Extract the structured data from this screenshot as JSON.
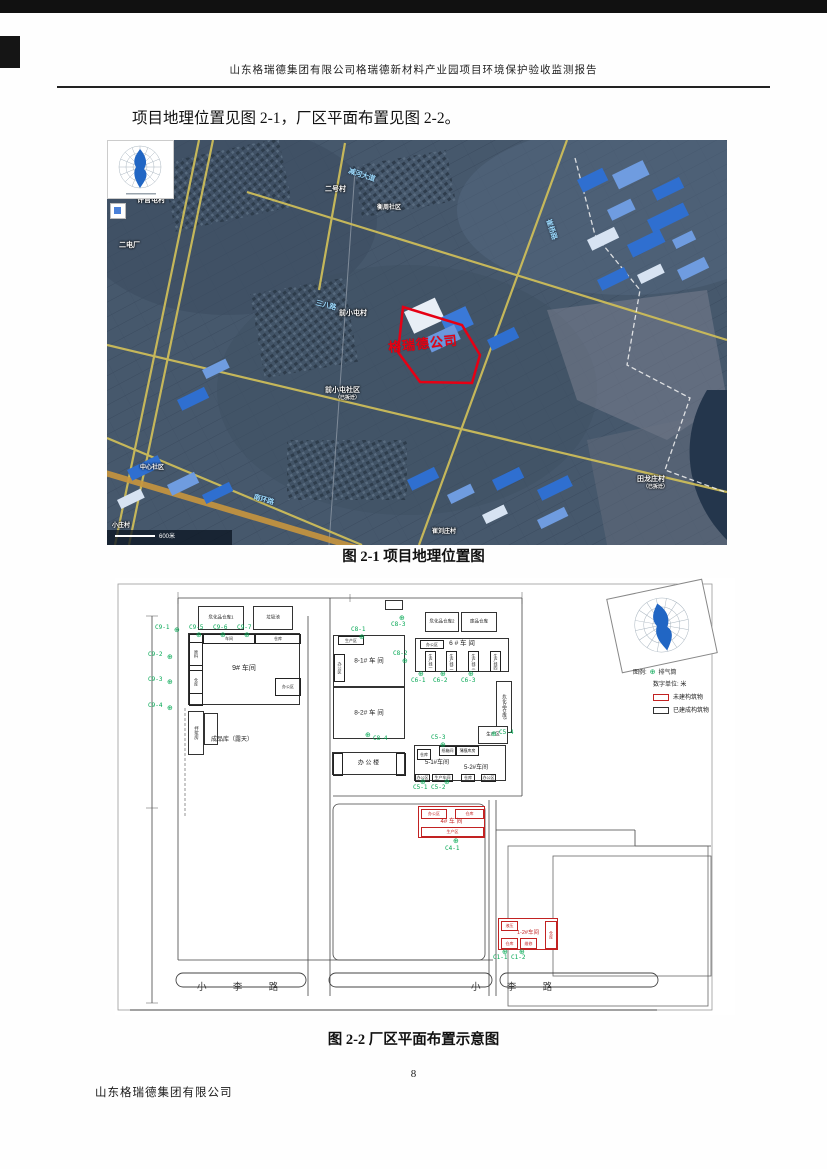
{
  "page": {
    "header": "山东格瑞德集团有限公司格瑞德新材料产业园项目环境保护验收监测报告",
    "intro": "项目地理位置见图 2-1，厂区平面布置见图 2-2。",
    "fig1_caption": "图 2-1 项目地理位置图",
    "fig2_caption": "图 2-2 厂区平面布置示意图",
    "page_number": "8",
    "footer": "山东格瑞德集团有限公司"
  },
  "map": {
    "scale_text": "600米",
    "labels": [
      {
        "t": "许官屯村",
        "x": 30,
        "y": 55
      },
      {
        "t": "二电厂",
        "x": 12,
        "y": 100
      },
      {
        "t": "二号村",
        "x": 218,
        "y": 44
      },
      {
        "t": "衡周社区",
        "x": 270,
        "y": 62,
        "fs": 6
      },
      {
        "t": "前小屯村",
        "x": 232,
        "y": 168
      },
      {
        "t": "前小屯社区",
        "x": 218,
        "y": 245
      },
      {
        "t": "（已拆迁）",
        "x": 228,
        "y": 254,
        "fs": 5
      },
      {
        "t": "中心社区",
        "x": 33,
        "y": 322,
        "fs": 6
      },
      {
        "t": "田龙庄村",
        "x": 530,
        "y": 334
      },
      {
        "t": "（已拆迁）",
        "x": 536,
        "y": 343,
        "fs": 5
      },
      {
        "t": "崔刘庄村",
        "x": 325,
        "y": 386,
        "fs": 6
      },
      {
        "t": "小庄村",
        "x": 5,
        "y": 380,
        "fs": 6
      },
      {
        "t": "格瑞德公司",
        "x": 280,
        "y": 197,
        "cls": "red",
        "fs": 13,
        "rot": -6
      }
    ],
    "road_labels": [
      {
        "t": "减河大道",
        "x": 243,
        "y": 26,
        "rot": 18
      },
      {
        "t": "崔杨路",
        "x": 446,
        "y": 78,
        "rot": 72
      },
      {
        "t": "三八路",
        "x": 210,
        "y": 158,
        "rot": 14
      },
      {
        "t": "南环路",
        "x": 148,
        "y": 352,
        "rot": 16
      }
    ]
  },
  "plan": {
    "legend": {
      "title": "图例:",
      "stack": "排气筒",
      "unit": "数字单位: 米",
      "red": "未建构筑物",
      "black": "已建成构筑物"
    },
    "roads": {
      "left": "小 李 路",
      "right": "小 李 路"
    },
    "free_labels": [
      {
        "t": "成品库（露天）",
        "x": 96,
        "y": 156,
        "fs": 6
      },
      {
        "t": "5-1#车间",
        "x": 310,
        "y": 179,
        "fs": 6
      },
      {
        "t": "5-2#车间",
        "x": 349,
        "y": 184,
        "fs": 6
      }
    ],
    "buildings": [
      {
        "label": "危化品仓库1",
        "x": 83,
        "y": 28,
        "w": 46,
        "h": 24,
        "c": "k",
        "fs": 4.5
      },
      {
        "label": "垃圾池",
        "x": 138,
        "y": 28,
        "w": 40,
        "h": 24,
        "c": "k",
        "fs": 4.5
      },
      {
        "label": "9# 车间",
        "x": 73,
        "y": 55,
        "w": 112,
        "h": 72,
        "c": "k",
        "fs": 7,
        "rooms": [
          {
            "x": 0,
            "y": 0,
            "w": 14,
            "h": 72
          },
          {
            "x": 0,
            "y": 8,
            "w": 14,
            "h": 24,
            "t": "原料",
            "v": 1
          },
          {
            "x": 0,
            "y": 36,
            "w": 14,
            "h": 24,
            "t": "仓库",
            "v": 1
          },
          {
            "x": 14,
            "y": 0,
            "w": 52,
            "h": 10,
            "t": "车间"
          },
          {
            "x": 66,
            "y": 0,
            "w": 46,
            "h": 10,
            "t": "仓库"
          },
          {
            "x": 86,
            "y": 44,
            "w": 26,
            "h": 18,
            "t": "办公区"
          }
        ]
      },
      {
        "label": "拌浆房",
        "x": 73,
        "y": 133,
        "w": 16,
        "h": 44,
        "c": "k",
        "v": 1,
        "fs": 4.5
      },
      {
        "label": "",
        "x": 89,
        "y": 135,
        "w": 14,
        "h": 32,
        "c": "k"
      },
      {
        "label": "8-1# 车 间",
        "x": 218,
        "y": 57,
        "w": 72,
        "h": 52,
        "c": "k",
        "fs": 6.5,
        "rooms": [
          {
            "x": 4,
            "y": 0,
            "w": 26,
            "h": 9,
            "t": "生产区"
          },
          {
            "x": 0,
            "y": 18,
            "w": 11,
            "h": 28,
            "t": "办公区",
            "v": 1
          }
        ]
      },
      {
        "label": "8-2# 车 间",
        "x": 218,
        "y": 109,
        "w": 72,
        "h": 52,
        "c": "k",
        "fs": 6.5
      },
      {
        "label": "办 公 楼",
        "x": 217,
        "y": 174,
        "w": 73,
        "h": 23,
        "c": "k",
        "fs": 6,
        "rooms": [
          {
            "x": 0,
            "y": 0,
            "w": 10,
            "h": 23
          },
          {
            "x": 63,
            "y": 0,
            "w": 10,
            "h": 23
          }
        ]
      },
      {
        "label": "危化品仓库2",
        "x": 310,
        "y": 34,
        "w": 34,
        "h": 20,
        "c": "k",
        "fs": 4.5
      },
      {
        "label": "废品仓库",
        "x": 346,
        "y": 34,
        "w": 36,
        "h": 20,
        "c": "k",
        "fs": 4.5
      },
      {
        "label": "6 # 车 间",
        "x": 300,
        "y": 60,
        "w": 94,
        "h": 34,
        "c": "k",
        "fs": 6.5,
        "ly": 1,
        "rooms": [
          {
            "x": 4,
            "y": 1,
            "w": 24,
            "h": 9,
            "t": "办公区"
          },
          {
            "x": 9,
            "y": 12,
            "w": 11,
            "h": 21,
            "t": "生产线一",
            "v": 1
          },
          {
            "x": 30,
            "y": 12,
            "w": 11,
            "h": 21,
            "t": "生产线二",
            "v": 1
          },
          {
            "x": 52,
            "y": 12,
            "w": 11,
            "h": 21,
            "t": "生产线三",
            "v": 1
          },
          {
            "x": 74,
            "y": 12,
            "w": 11,
            "h": 21,
            "t": "生产线四",
            "v": 1
          }
        ]
      },
      {
        "label": "危化品仓库3",
        "x": 381,
        "y": 103,
        "w": 16,
        "h": 52,
        "c": "k",
        "v": 1,
        "fs": 4.5
      },
      {
        "label": "生产区",
        "x": 363,
        "y": 148,
        "w": 30,
        "h": 18,
        "c": "k",
        "fs": 4.5
      },
      {
        "label": "",
        "x": 299,
        "y": 167,
        "w": 92,
        "h": 36,
        "c": "k",
        "rooms": [
          {
            "x": 2,
            "y": 3,
            "w": 14,
            "h": 11,
            "t": "仓库"
          },
          {
            "x": 24,
            "y": 0,
            "w": 17,
            "h": 10,
            "t": "纸箱间"
          },
          {
            "x": 41,
            "y": 0,
            "w": 23,
            "h": 10,
            "t": "薄膜库房"
          },
          {
            "x": 0,
            "y": 28,
            "w": 15,
            "h": 8,
            "t": "办公区"
          },
          {
            "x": 17,
            "y": 28,
            "w": 21,
            "h": 8,
            "t": "生产车间"
          },
          {
            "x": 46,
            "y": 28,
            "w": 14,
            "h": 8,
            "t": "仓库"
          },
          {
            "x": 66,
            "y": 28,
            "w": 15,
            "h": 8,
            "t": "办公区"
          }
        ]
      },
      {
        "label": "4# 车 间",
        "x": 303,
        "y": 228,
        "w": 67,
        "h": 32,
        "c": "r",
        "ly": 12,
        "fs": 6,
        "rooms": [
          {
            "x": 2,
            "y": 2,
            "w": 26,
            "h": 10,
            "t": "办公区"
          },
          {
            "x": 36,
            "y": 2,
            "w": 29,
            "h": 10,
            "t": "仓库"
          },
          {
            "x": 2,
            "y": 20,
            "w": 63,
            "h": 10,
            "t": "生产区"
          }
        ]
      },
      {
        "label": "1-2#车间",
        "x": 383,
        "y": 340,
        "w": 60,
        "h": 32,
        "c": "r",
        "ly": 11,
        "fs": 5.5,
        "rooms": [
          {
            "x": 2,
            "y": 2,
            "w": 17,
            "h": 10,
            "t": "液压"
          },
          {
            "x": 2,
            "y": 19,
            "w": 17,
            "h": 11,
            "t": "仓库"
          },
          {
            "x": 21,
            "y": 19,
            "w": 17,
            "h": 11,
            "t": "维修"
          },
          {
            "x": 46,
            "y": 2,
            "w": 12,
            "h": 28,
            "t": "仓库",
            "v": 1
          }
        ]
      },
      {
        "label": "",
        "x": 270,
        "y": 22,
        "w": 18,
        "h": 10,
        "c": "k"
      }
    ],
    "monitor_points": [
      {
        "id": "C9-1",
        "t": [
          40,
          46
        ],
        "d": [
          59,
          49
        ]
      },
      {
        "id": "C9-5",
        "t": [
          74,
          46
        ],
        "d": [
          81,
          54
        ]
      },
      {
        "id": "C9-6",
        "t": [
          98,
          46
        ],
        "d": [
          105,
          54
        ]
      },
      {
        "id": "C9-7",
        "t": [
          122,
          46
        ],
        "d": [
          129,
          54
        ]
      },
      {
        "id": "C9-2",
        "t": [
          33,
          73
        ],
        "d": [
          52,
          76
        ]
      },
      {
        "id": "C9-3",
        "t": [
          33,
          98
        ],
        "d": [
          52,
          101
        ]
      },
      {
        "id": "C9-4",
        "t": [
          33,
          124
        ],
        "d": [
          52,
          127
        ]
      },
      {
        "id": "C8-1",
        "t": [
          236,
          48
        ],
        "d": [
          244,
          56
        ]
      },
      {
        "id": "C8-3",
        "t": [
          276,
          43
        ],
        "d": [
          284,
          37
        ]
      },
      {
        "id": "C8-2",
        "t": [
          278,
          72
        ],
        "d": [
          287,
          80
        ]
      },
      {
        "id": "C8-4",
        "t": [
          258,
          157
        ],
        "d": [
          250,
          154
        ]
      },
      {
        "id": "C6-1",
        "t": [
          296,
          99
        ],
        "d": [
          303,
          93
        ]
      },
      {
        "id": "C6-2",
        "t": [
          318,
          99
        ],
        "d": [
          325,
          93
        ]
      },
      {
        "id": "C6-3",
        "t": [
          346,
          99
        ],
        "d": [
          353,
          93
        ]
      },
      {
        "id": "C5-4",
        "t": [
          384,
          151
        ],
        "d": [
          376,
          153
        ]
      },
      {
        "id": "C5-3",
        "t": [
          316,
          156
        ],
        "d": [
          325,
          164
        ]
      },
      {
        "id": "C5-1 C5-2",
        "t": [
          298,
          206
        ],
        "d": [
          305,
          201
        ]
      },
      {
        "id": "",
        "t": [
          0,
          0
        ],
        "d": [
          329,
          201
        ]
      },
      {
        "id": "C4-1",
        "t": [
          330,
          267
        ],
        "d": [
          338,
          260
        ]
      },
      {
        "id": "C1-1 C1-2",
        "t": [
          378,
          376
        ],
        "d": [
          387,
          371
        ]
      },
      {
        "id": "",
        "t": [
          0,
          0
        ],
        "d": [
          404,
          371
        ]
      }
    ]
  }
}
